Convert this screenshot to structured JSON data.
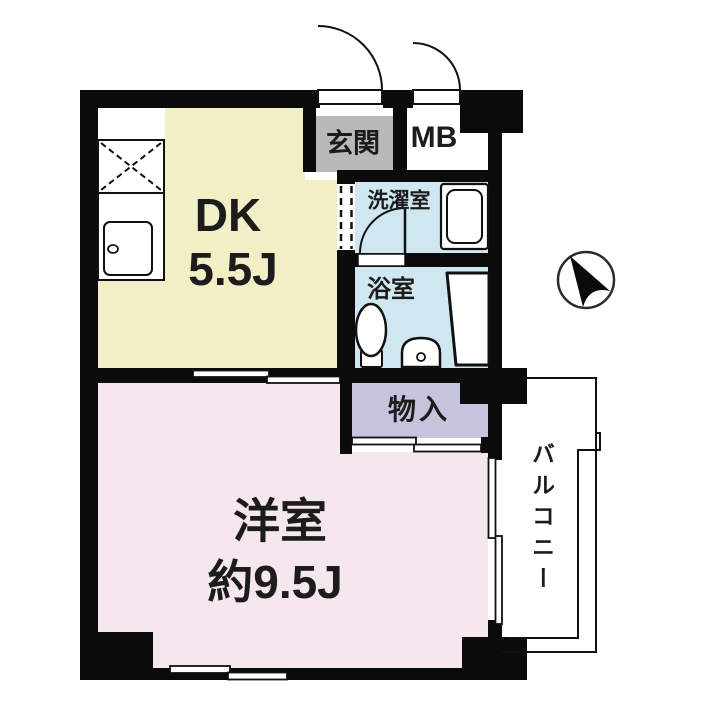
{
  "plan_title": "apartment-floor-plan",
  "rooms": {
    "dk": {
      "name": "DK",
      "size": "5.5J",
      "color": "#f2eec5"
    },
    "entrance": {
      "name": "玄関",
      "color": "#b9b9b9"
    },
    "meter_box": {
      "name": "MB",
      "color": "#ffffff"
    },
    "laundry": {
      "name": "洗濯室",
      "color": "#cfe7f0"
    },
    "bathroom": {
      "name": "浴室",
      "color": "#cfe7f0"
    },
    "storage": {
      "name": "物入",
      "color": "#c4c5dd"
    },
    "western_room": {
      "name": "洋室",
      "size": "約9.5J",
      "color": "#f6e7ee"
    },
    "balcony": {
      "name": "バルコニー",
      "color": "#ffffff"
    }
  },
  "wall_color": "#0b0b0b",
  "fixtures": [
    "kitchen-stove",
    "kitchen-sink",
    "washing-machine",
    "toilet",
    "washbasin",
    "bathtub"
  ],
  "doors": [
    "entrance-swing-door",
    "meter-box-swing-door",
    "bathroom-swing-door",
    "dk-west-sliding-door",
    "storage-sliding-door",
    "balcony-sliding-window",
    "south-sliding-window",
    "laundry-dashed-opening"
  ],
  "compass": {
    "icon": "north-arrow"
  }
}
